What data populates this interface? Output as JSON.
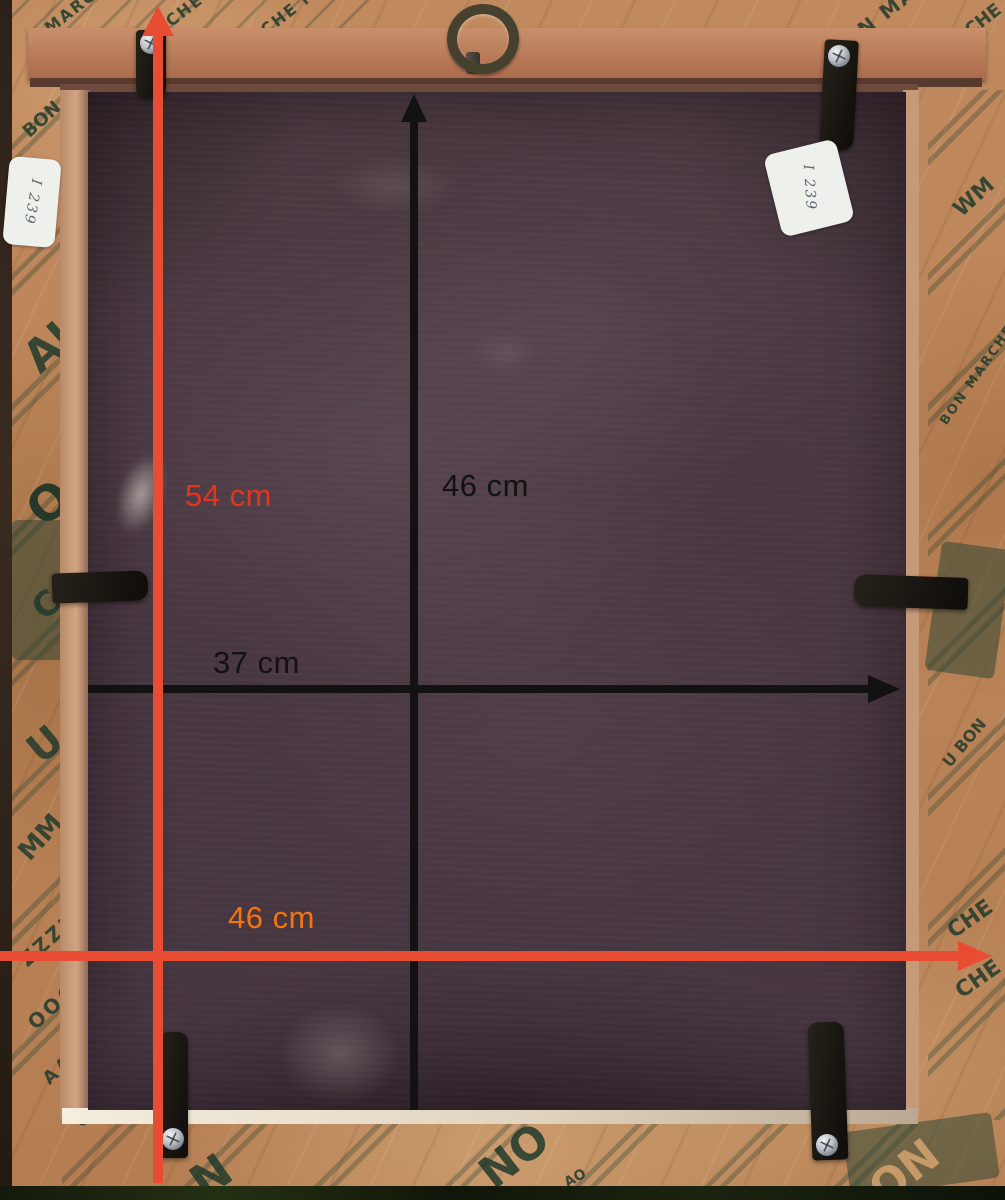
{
  "measurements": {
    "frame_height": {
      "label": "54 cm",
      "color": "#e6331c",
      "arrow_color": "#e84c33",
      "orientation": "vertical"
    },
    "frame_width": {
      "label": "46 cm",
      "color": "#f5740c",
      "arrow_color": "#e84c33",
      "orientation": "horizontal"
    },
    "board_height": {
      "label": "46 cm",
      "color": "#121212",
      "arrow_color": "#121212",
      "orientation": "vertical"
    },
    "board_width": {
      "label": "37 cm",
      "color": "#121212",
      "arrow_color": "#121212",
      "orientation": "horizontal"
    }
  },
  "stickers": {
    "left": {
      "text": "I 239"
    },
    "right": {
      "text": "I 239"
    }
  },
  "tape": {
    "brand": "BON MARCHE",
    "prints": [
      "MARCHE",
      "RCHE MA",
      "CHE MAR",
      "N MA",
      "CHE",
      "BON",
      "AU",
      "O",
      "C",
      "U",
      "MM",
      "ZZZZ",
      "OOOO",
      "AAAA",
      "CCCC",
      "N",
      "NO",
      "AO",
      "ON",
      "WM",
      "BON MARCHE",
      "U BON",
      "CHE",
      "CHE"
    ]
  },
  "colors": {
    "kraft_tape": "#b9835c",
    "tape_print_green": "#2d4a3b",
    "backing_board": "#47363f",
    "frame_wood": "#b5714f",
    "red_arrow": "#e84c33",
    "orange_label": "#f5740c"
  }
}
